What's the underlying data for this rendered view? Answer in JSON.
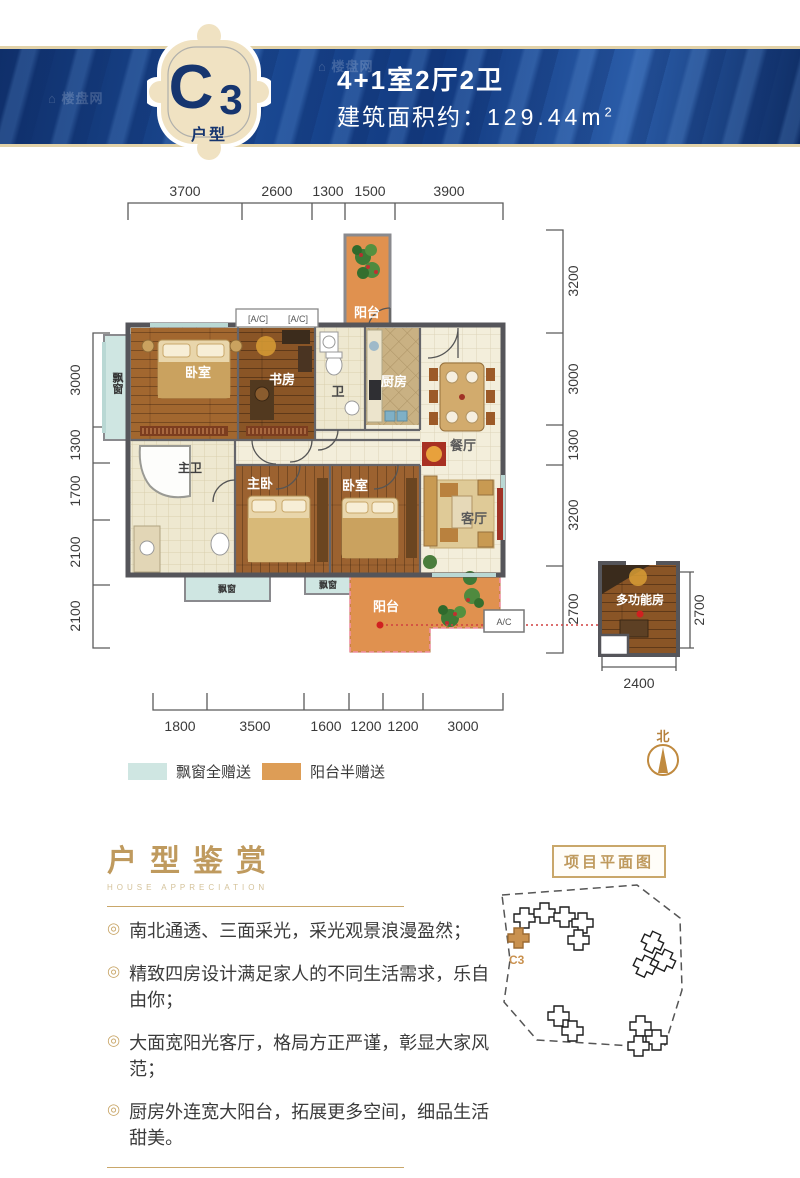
{
  "watermark": {
    "text": "楼盘网"
  },
  "banner": {
    "badge": {
      "code_main": "C",
      "code_sub": "3",
      "label": "户型"
    },
    "title": "4+1室2厅2卫",
    "area_prefix": "建筑面积约：",
    "area_value": "129.44m",
    "area_sup": "2"
  },
  "floorplan": {
    "dims": {
      "top": [
        "3700",
        "2600",
        "1300",
        "1500",
        "3900"
      ],
      "left": [
        "3000",
        "1300",
        "1700",
        "2100",
        "2100"
      ],
      "right": [
        "3200",
        "3000",
        "1300",
        "3200",
        "2700"
      ],
      "bottom": [
        "1800",
        "3500",
        "1600",
        "1200",
        "1200",
        "3000"
      ],
      "annex_right": "2700",
      "annex_bottom": "2400"
    },
    "rooms": {
      "balcony_top": "阳台",
      "bedroom_top": "卧室",
      "bay_window_left": "飘窗",
      "study": "书房",
      "bath": "卫",
      "kitchen": "厨房",
      "dining": "餐厅",
      "master_bath": "主卫",
      "master_bedroom": "主卧",
      "bedroom_bottom": "卧室",
      "living": "客厅",
      "bay_window_b1": "飘窗",
      "bay_window_b2": "飘窗",
      "balcony_bottom": "阳台",
      "multi_room": "多功能房"
    },
    "ac_label": "A/C",
    "north_label": "北",
    "legend": [
      {
        "color": "#cfe6e2",
        "label": "飘窗全赠送"
      },
      {
        "color": "#dd9d56",
        "label": "阳台半赠送"
      }
    ]
  },
  "appreciation": {
    "title": "户型鉴赏",
    "subtitle": "HOUSE APPRECIATION",
    "bullet_marker": "◎",
    "bullets": [
      "南北通透、三面采光，采光观景浪漫盈然；",
      "精致四房设计满足家人的不同生活需求，乐自由你；",
      "大面宽阳光客厅，格局方正严谨，彰显大家风范；",
      "厨房外连宽大阳台，拓展更多空间，细品生活甜美。"
    ]
  },
  "siteplan": {
    "title": "项目平面图",
    "unit_label": "C3"
  },
  "colors": {
    "banner_blue": "#16408c",
    "badge_cream": "#f0e2c2",
    "accent_tan": "#bf9a5e",
    "balcony_orange": "#e0914f",
    "bay_blue": "#cfe6e2",
    "wall_gray": "#55555a"
  }
}
